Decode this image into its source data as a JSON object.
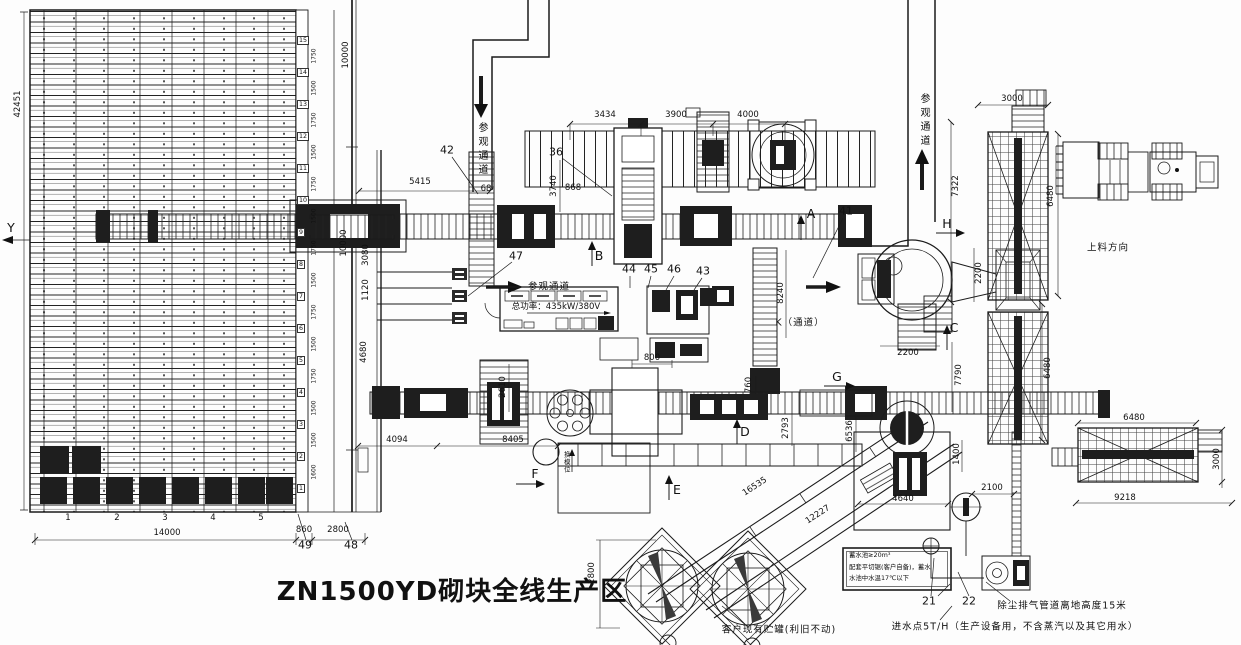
{
  "title": "ZN1500YD砌块全线生产区",
  "notes": {
    "power": "总功率：435kW/380V",
    "visitor_top": "参观通道",
    "visitor_mid": "参观通道",
    "visitor_right": "参观通道",
    "k_passage": "K（通道）",
    "feed_direction": "上料方向",
    "mold_change": "换模位",
    "tank_existing": "客户现有贮罐(利旧不动)",
    "water_box_line1": "蓄水池≥20m³",
    "water_box_line2": "配套平切锯(客户自备)，蓄水",
    "water_box_line3": "水池中水温17℃以下",
    "dust_note": "除尘排气管道离地高度15米",
    "water_inlet_note": "进水点5T/H（生产设备用，不含蒸汽以及其它用水）"
  },
  "markers": {
    "a": "A",
    "b": "B",
    "c": "C",
    "d": "D",
    "e": "E",
    "f": "F",
    "g": "G",
    "h": "H",
    "y": "Y"
  },
  "items": {
    "n21": "21",
    "n22": "22",
    "n36": "36",
    "n41": "41",
    "n42": "42",
    "n43": "43",
    "n44": "44",
    "n45": "45",
    "n46": "46",
    "n47": "47",
    "n48": "48",
    "n49": "49"
  },
  "dims": [
    "42451",
    "10000",
    "10000",
    "3080",
    "1120",
    "4680",
    "5415",
    "3434",
    "3900",
    "4000",
    "3000",
    "7322",
    "6480",
    "2200",
    "2200",
    "7790",
    "6480",
    "3740",
    "68",
    "868",
    "8240",
    "2610",
    "800",
    "4094",
    "8405",
    "760",
    "2793",
    "6536",
    "16535",
    "12227",
    "2800",
    "14000",
    "860",
    "2800",
    "1400",
    "2100",
    "4640",
    "9218",
    "6480",
    "3000"
  ],
  "rack": {
    "bays": [
      "1",
      "2",
      "3",
      "4",
      "5"
    ],
    "row_numbers": [
      "15",
      "14",
      "13",
      "12",
      "11",
      "10",
      "9",
      "8",
      "7",
      "6",
      "5",
      "4",
      "3",
      "2",
      "1"
    ],
    "row_spacings": [
      "1750",
      "1500",
      "1750",
      "1500",
      "1750",
      "1500",
      "1750",
      "1500",
      "1750",
      "1500",
      "1750",
      "1500",
      "1500",
      "1600"
    ]
  },
  "colors": {
    "ink": "#1b1b1b",
    "paper": "#fdfdfd",
    "machine_fill": "#1e1e1e"
  }
}
